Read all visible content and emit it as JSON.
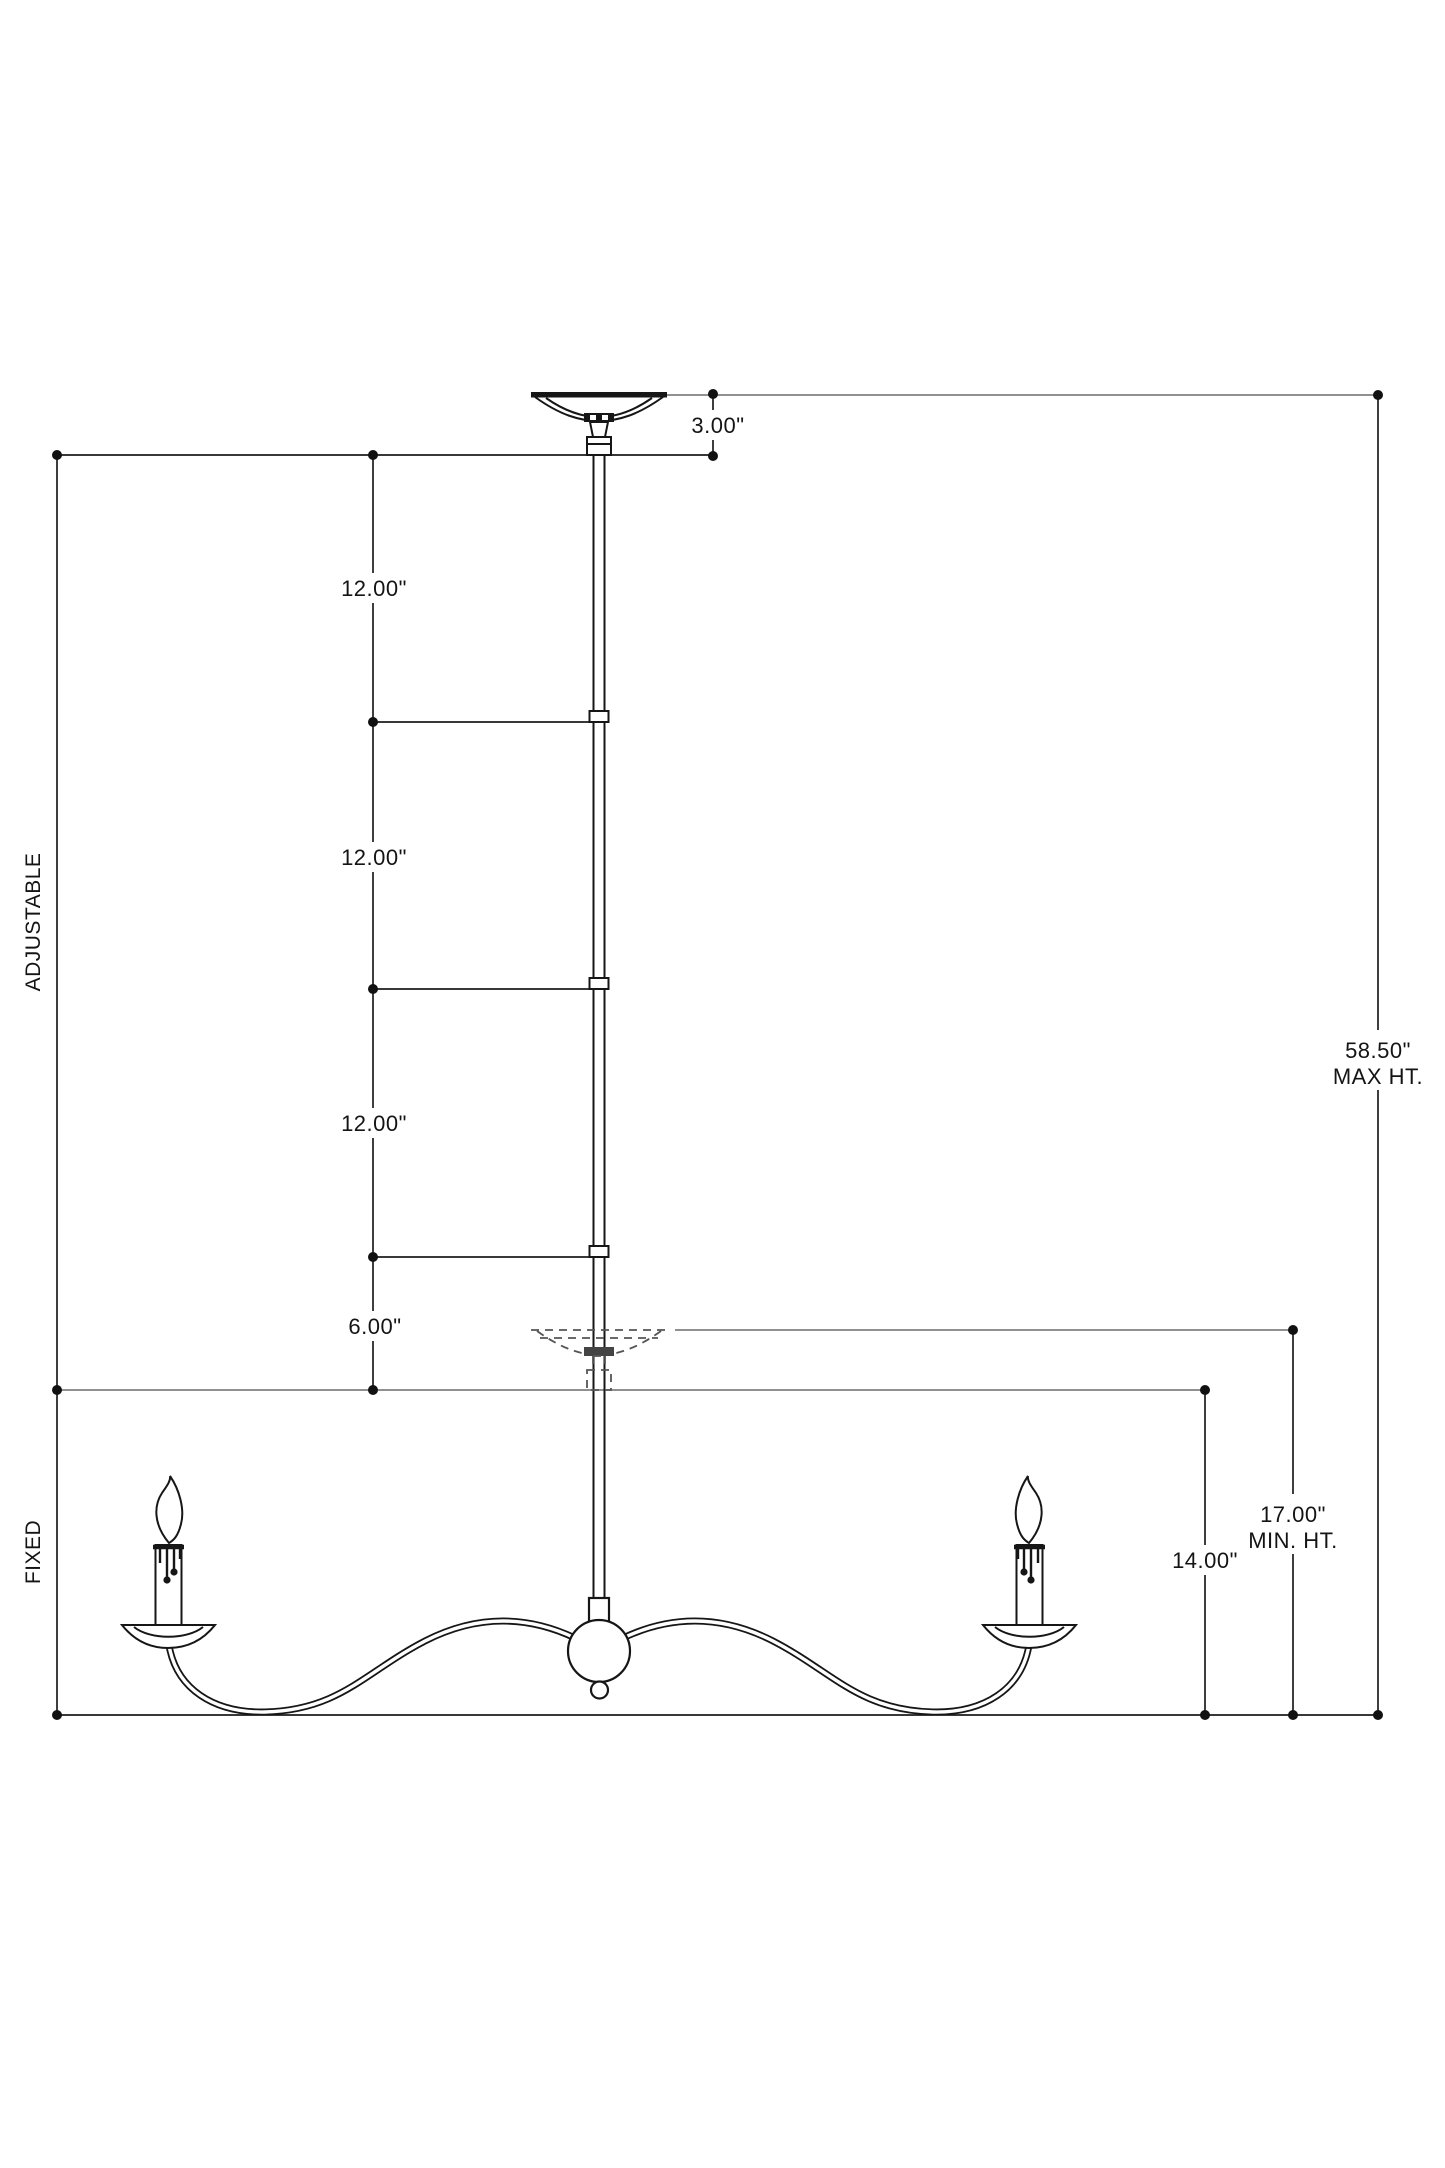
{
  "drawing": {
    "type_label": "Two-arm chandelier installation dimension drawing",
    "sections": {
      "adjustable": "ADJUSTABLE",
      "fixed": "FIXED"
    },
    "dimensions": {
      "canopy_drop": "3.00\"",
      "rod_segments": [
        "12.00\"",
        "12.00\"",
        "12.00\""
      ],
      "slip_section": "6.00\"",
      "max_height_value": "58.50\"",
      "max_height_label": "MAX HT.",
      "min_height_value": "17.00\"",
      "min_height_label": "MIN. HT.",
      "fixture_height": "14.00\""
    },
    "colors": {
      "dimension_line": "#1c1c1c",
      "reference_line": "#6b6b6b",
      "fixture_line": "#161616",
      "background": "#ffffff"
    }
  }
}
